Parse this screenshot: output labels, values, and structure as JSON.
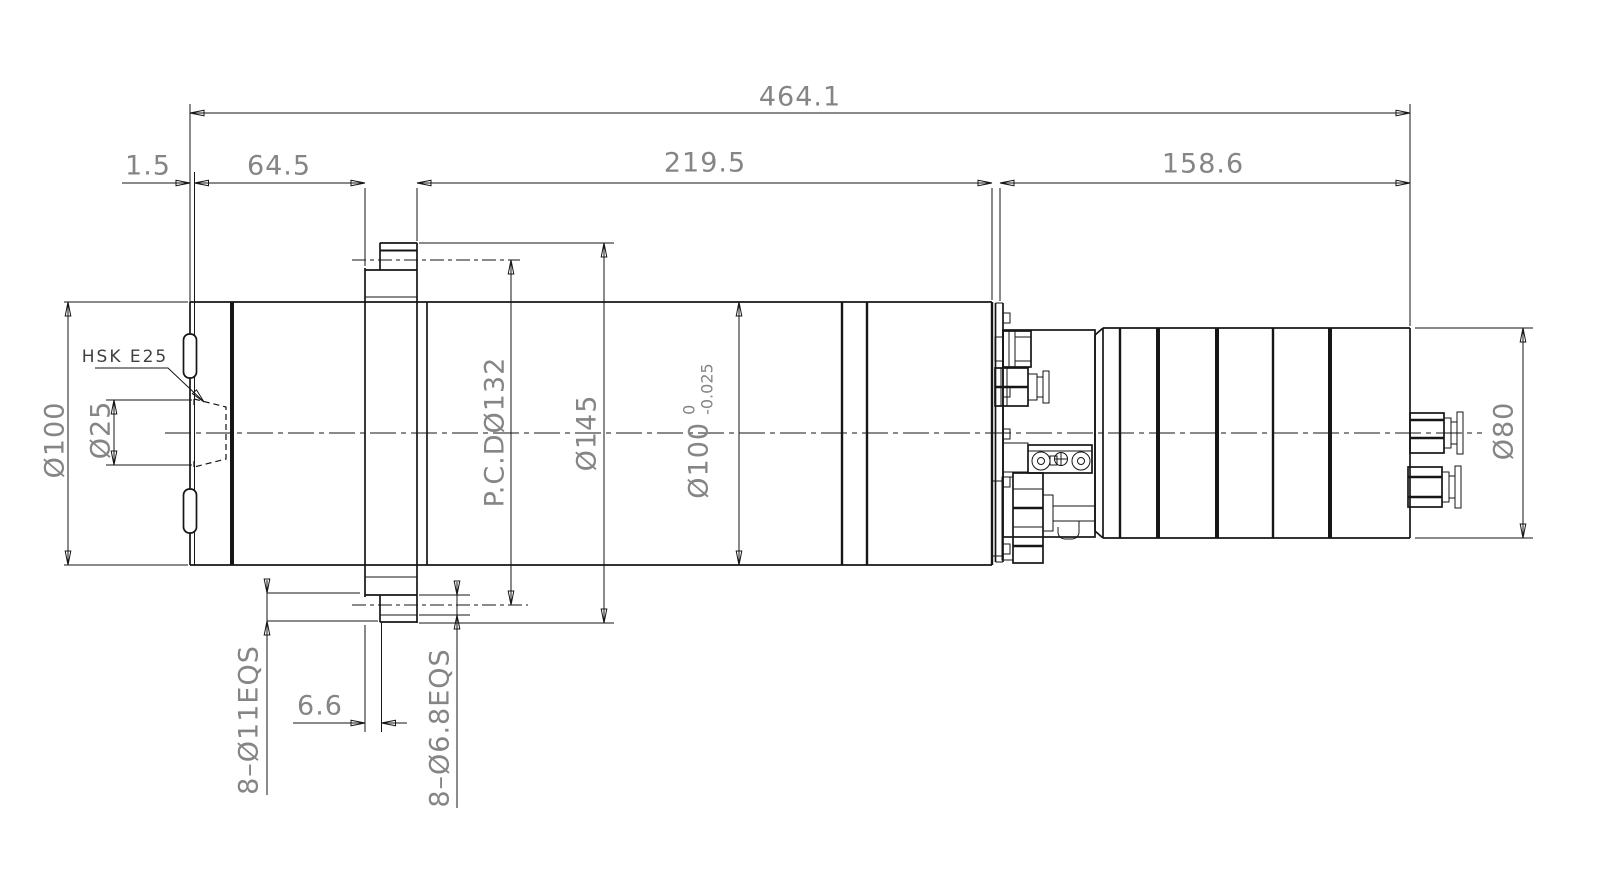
{
  "drawing": {
    "background": "#ffffff",
    "line_color": "#161616",
    "dim_text_color": "#858585",
    "label_text_color": "#3f3f3f",
    "dims_horizontal": {
      "overall_length": "464.1",
      "nose_protrusion": "1.5",
      "front_section": "64.5",
      "mid_section": "219.5",
      "rear_section": "158.6",
      "flange_step": "6.6"
    },
    "dims_vertical": {
      "front_od": "Ø100",
      "taper_bore": "Ø25",
      "bolt_circle": "P.C.DØ132",
      "flange_od": "Ø145",
      "body_od": "Ø100",
      "body_od_tol_upper": "0",
      "body_od_tol_lower": "-0.025",
      "rear_od": "Ø80"
    },
    "labels": {
      "taper_type": "HSK E25",
      "flange_holes": "8–Ø11EQS",
      "mount_holes": "8–Ø6.8EQS"
    }
  }
}
